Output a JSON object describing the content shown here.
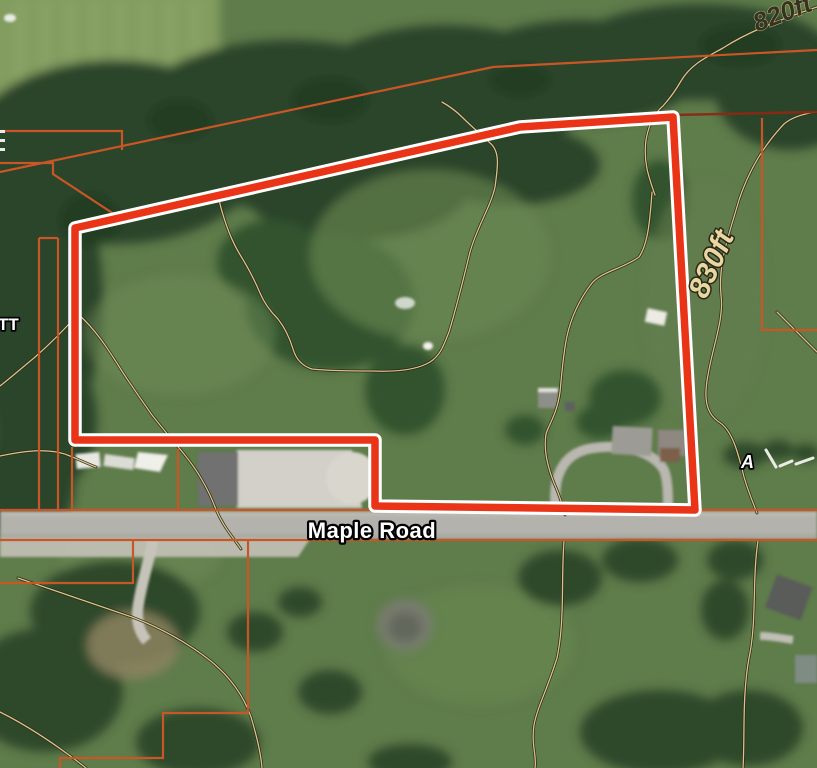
{
  "map": {
    "title": "Aerial parcel map with property boundary",
    "road_label": "Maple Road",
    "contour_label_820": "820ft",
    "contour_label_830": "830ft",
    "edge_label_left": "TT",
    "edge_label_right": "A",
    "colors": {
      "boundary": "#e93418",
      "boundary_casing": "#ffffff",
      "parcel_line": "#c95627",
      "parcel_line_dark": "#8a2a14",
      "contour_line": "#d9c58b",
      "contour_casing": "#2a2817",
      "contour_label": "#e9d7a2",
      "contour_label_dark": "#35321f",
      "road_label_color": "#ffffff"
    }
  }
}
